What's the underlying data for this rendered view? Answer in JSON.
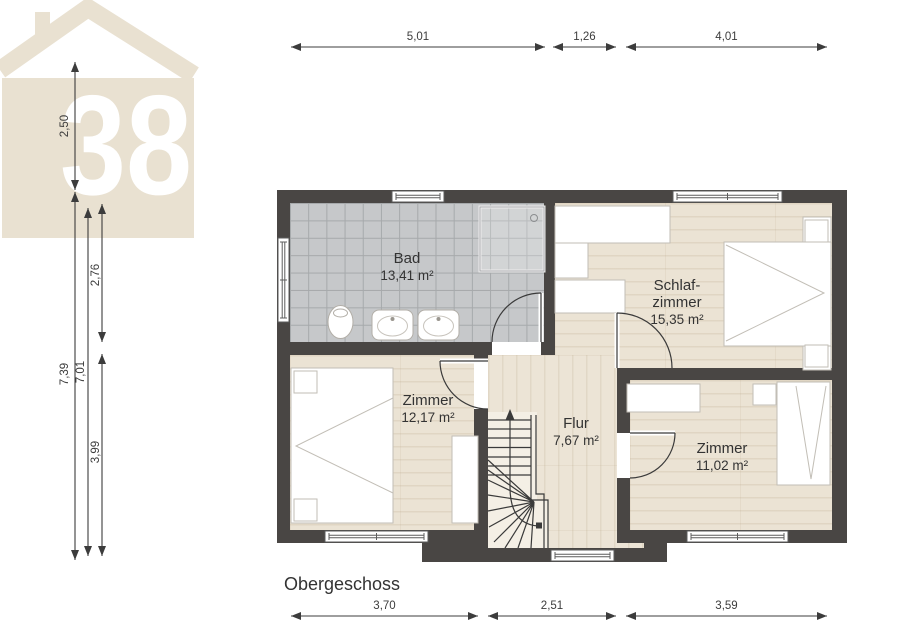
{
  "logo": {
    "number": "38",
    "color": "#e9e1d1"
  },
  "plan": {
    "title": "Obergeschoss",
    "rooms": [
      {
        "id": "bad",
        "name": "Bad",
        "name2": "",
        "area": "13,41 m²"
      },
      {
        "id": "schlafzimmer",
        "name": "Schlaf-",
        "name2": "zimmer",
        "area": "15,35 m²"
      },
      {
        "id": "zimmer-links",
        "name": "Zimmer",
        "name2": "",
        "area": "12,17 m²"
      },
      {
        "id": "flur",
        "name": "Flur",
        "name2": "",
        "area": "7,67 m²"
      },
      {
        "id": "zimmer-rechts",
        "name": "Zimmer",
        "name2": "",
        "area": "11,02 m²"
      }
    ],
    "dimensions": {
      "top": [
        "5,01",
        "1,26",
        "4,01"
      ],
      "bottom": [
        "3,70",
        "2,51",
        "3,59"
      ],
      "left": [
        "2,50",
        "7,39",
        "7,01",
        "2,76",
        "3,99"
      ]
    },
    "colors": {
      "wall": "#494644",
      "tile_floor": "#c6c8ca",
      "wood_floor": "#ebe3d4",
      "logo_beige": "#e9e1d1",
      "text": "#333333"
    }
  }
}
